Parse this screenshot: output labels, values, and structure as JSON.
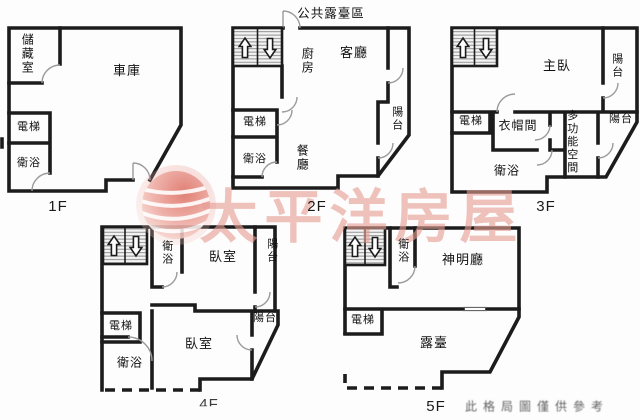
{
  "floors": {
    "f1": {
      "label": "1F",
      "rooms": {
        "storage": "儲藏室",
        "garage": "車庫",
        "elevator": "電梯",
        "bath": "衛浴"
      }
    },
    "f2": {
      "label": "2F",
      "area_label": "公共露臺區",
      "rooms": {
        "kitchen": "廚房",
        "living": "客廳",
        "elevator": "電梯",
        "bath": "衛浴",
        "dining": "餐廳",
        "balcony": "陽台"
      }
    },
    "f3": {
      "label": "3F",
      "rooms": {
        "master": "主臥",
        "balcony_top": "陽台",
        "elevator": "電梯",
        "closet": "衣帽間",
        "multi": "多功能空間",
        "bath": "衛浴",
        "balcony_mid": "陽台"
      }
    },
    "f4": {
      "label": "4F",
      "rooms": {
        "bath_top": "衛浴",
        "bedroom_top": "臥室",
        "balcony_top": "陽台",
        "elevator": "電梯",
        "bedroom": "臥室",
        "bath": "衛浴",
        "balcony_mid": "陽台"
      }
    },
    "f5": {
      "label": "5F",
      "rooms": {
        "bath": "衛浴",
        "shrine": "神明廳",
        "elevator": "電梯",
        "terrace": "露臺"
      }
    }
  },
  "watermark": {
    "brand": "太平洋房屋",
    "logo_color": "#dd6f63",
    "text_color": "#e59d93"
  },
  "disclaimer": "此格局圖僅供參考",
  "icons": {
    "stairs_up": "arrow-up",
    "stairs_down": "arrow-down"
  },
  "colors": {
    "walls": "#1c1c1c",
    "background": "#fdfdfd"
  }
}
